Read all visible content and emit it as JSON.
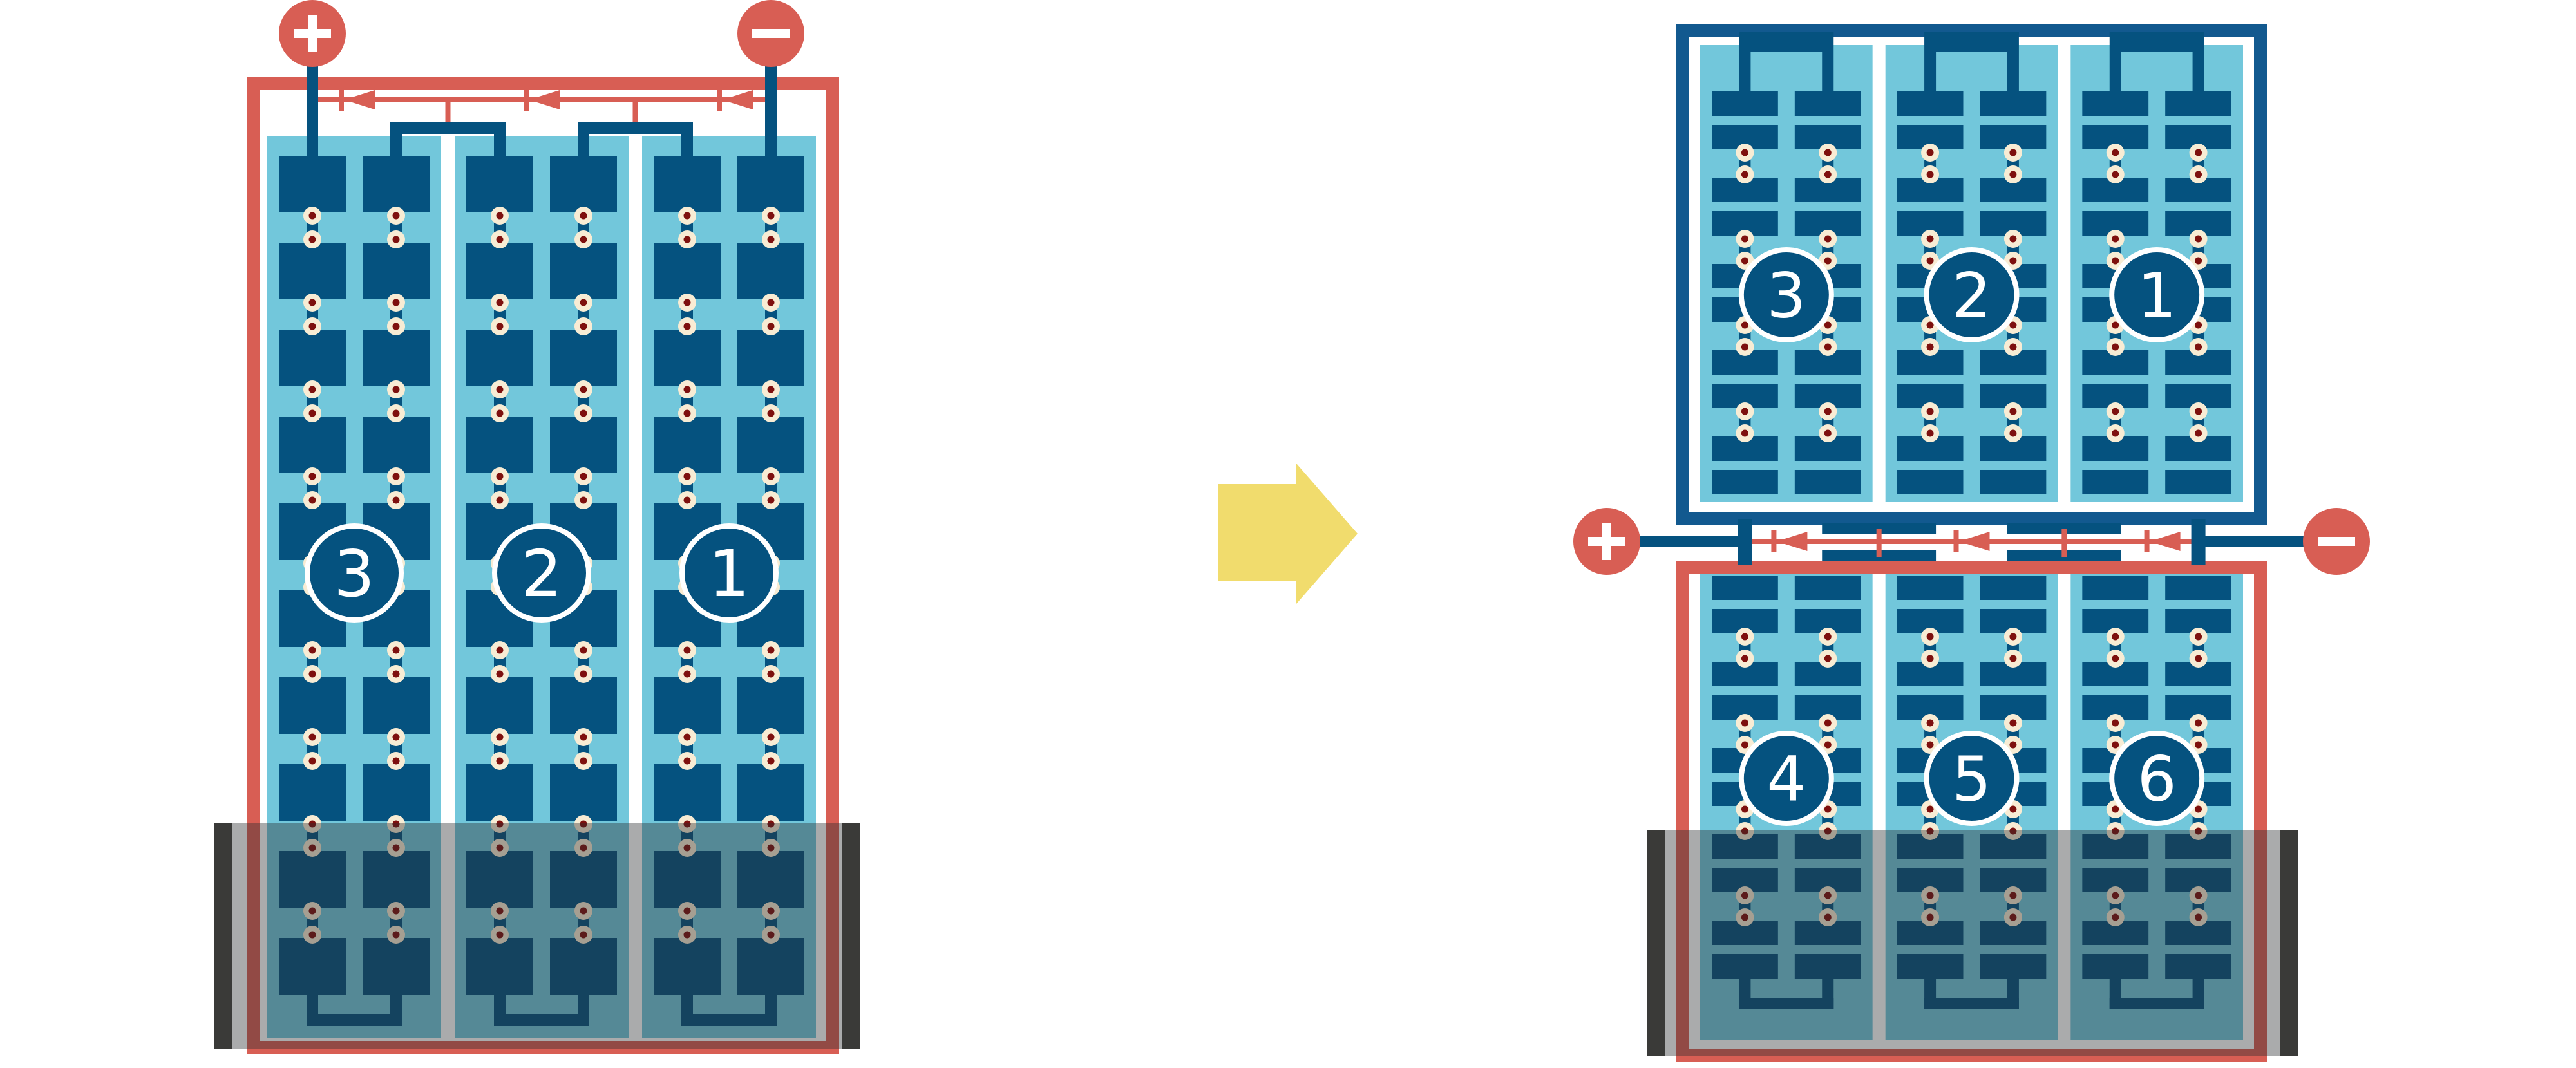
{
  "colors": {
    "red": "#d85e54",
    "cell_blue": "#05527f",
    "frame_blue": "#12598f",
    "light_blue": "#72c7db",
    "solder_cream": "#f8ecd4",
    "solder_dot_red": "#7e100e",
    "arrow_yellow": "#f1dc6d",
    "shade_bar_dark": "#3a3a38",
    "shade_overlay": "rgba(43,44,47,0.40)",
    "white": "#ffffff"
  },
  "left_module": {
    "terminal_positive": "+",
    "terminal_negative": "−",
    "string_labels": [
      "3",
      "2",
      "1"
    ],
    "bypass_diode_count": 3,
    "cell_rows": 10,
    "strings": 3,
    "shaded_bottom": true
  },
  "arrow": {
    "direction": "right"
  },
  "right_top_module": {
    "string_labels": [
      "3",
      "2",
      "1"
    ],
    "cell_bar_rows": 10,
    "strings": 3,
    "shaded_bottom": false
  },
  "right_bottom_module": {
    "string_labels": [
      "4",
      "5",
      "6"
    ],
    "cell_bar_rows": 10,
    "strings": 3,
    "shaded_bottom": true
  },
  "junction": {
    "terminal_positive": "+",
    "terminal_negative": "−",
    "bypass_diode_count": 3
  }
}
